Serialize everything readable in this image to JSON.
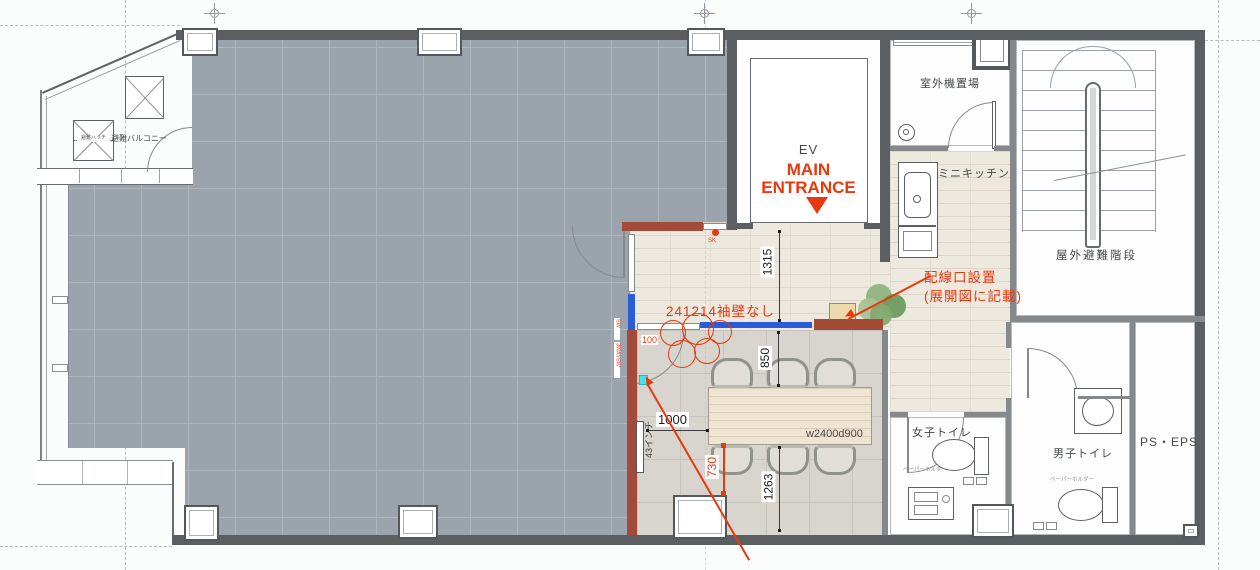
{
  "rooms": {
    "ev": {
      "label": "EV"
    },
    "main_entrance": {
      "line1": "MAIN",
      "line2": "ENTRANCE"
    },
    "outdoor_unit_area": {
      "label": "室外機置場"
    },
    "mini_kitchen": {
      "label": "ミニキッチン"
    },
    "outdoor_evac_stair": {
      "label": "屋外避難階段"
    },
    "evac_balcony": {
      "label": "避難バルコニー"
    },
    "evac_hatch": {
      "label": "避難ハッチ"
    },
    "womens_toilet": {
      "label": "女子トイレ"
    },
    "mens_toilet": {
      "label": "男子トイレ"
    },
    "ps_eps": {
      "label": "PS・EPS"
    }
  },
  "furniture": {
    "meeting_table": "w2400d900",
    "monitor": "43インチ",
    "paper_holder": "ペーパーホルダー"
  },
  "dimensions": {
    "hall_width": "1315",
    "table_top_clearance": "850",
    "table_left_clearance": "1000",
    "table_bottom_clearance": "1263",
    "red_730": "730",
    "red_100": "100"
  },
  "annotations": {
    "no_wing_wall": "241214袖壁なし",
    "wiring_port_1": "配線口設置",
    "wiring_port_2": "(展開図に記載)",
    "sk": "SK",
    "sw_upper": "SW",
    "sw_lower": "3WAYSW"
  },
  "colors": {
    "annotation_red": "#e8380d",
    "renovation_wall_brown": "#a34b38",
    "highlight_blue": "#2b5cd8",
    "marker_cyan": "#47e3e8",
    "plant_green": "#7fa96f",
    "floor_tile_gray": "#9ba4ac",
    "floor_wood_beige": "#ede9df",
    "wall_dark": "#5c5f62"
  }
}
